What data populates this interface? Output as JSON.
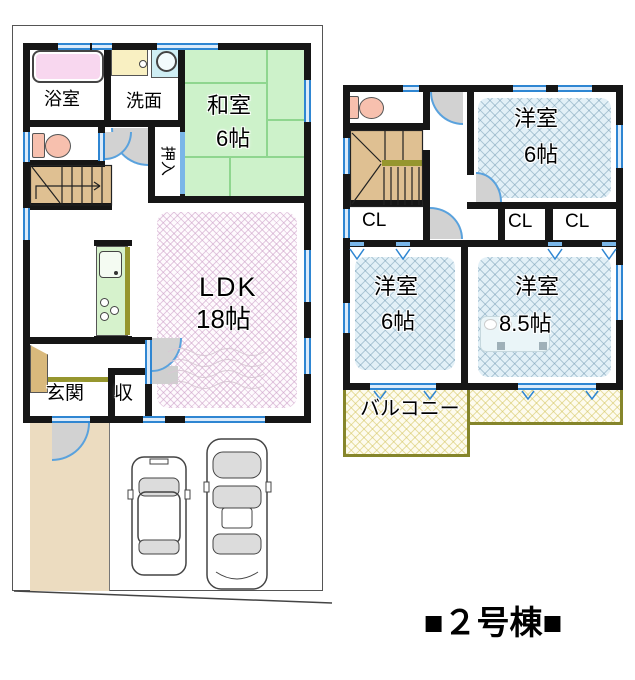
{
  "floor1": {
    "bath": "浴室",
    "washroom": "洗面",
    "japanese_room": "和室",
    "japanese_room_size": "6帖",
    "futon_closet": "押入",
    "ldk": "LDK",
    "ldk_size": "18帖",
    "entrance": "玄関",
    "storage": "収"
  },
  "floor2": {
    "western_room_top": "洋室",
    "western_room_top_size": "6帖",
    "closet_left": "CL",
    "closet_mid": "CL",
    "closet_right": "CL",
    "western_room_left": "洋室",
    "western_room_left_size": "6帖",
    "western_room_right": "洋室",
    "western_room_right_size": "8.5帖",
    "balcony": "バルコニー"
  },
  "caption": "■２号棟■",
  "colors": {
    "wall": "#161616",
    "window_blue": "#2f86d2",
    "tatami_green": "#cdf2ca",
    "hatch_blue_bg": "#e2f0f7",
    "hatch_pink_bg": "#fefafd",
    "balcony_border": "#85852a",
    "stairs_tan": "#dfc092",
    "approach_beige": "#ecdcc0",
    "toilet_pink": "#f7c0ae",
    "bathtub_pink": "#f8d7ef",
    "washbasin_yellow": "#f9f0c2",
    "kitchen_green": "#d6f2cc"
  }
}
